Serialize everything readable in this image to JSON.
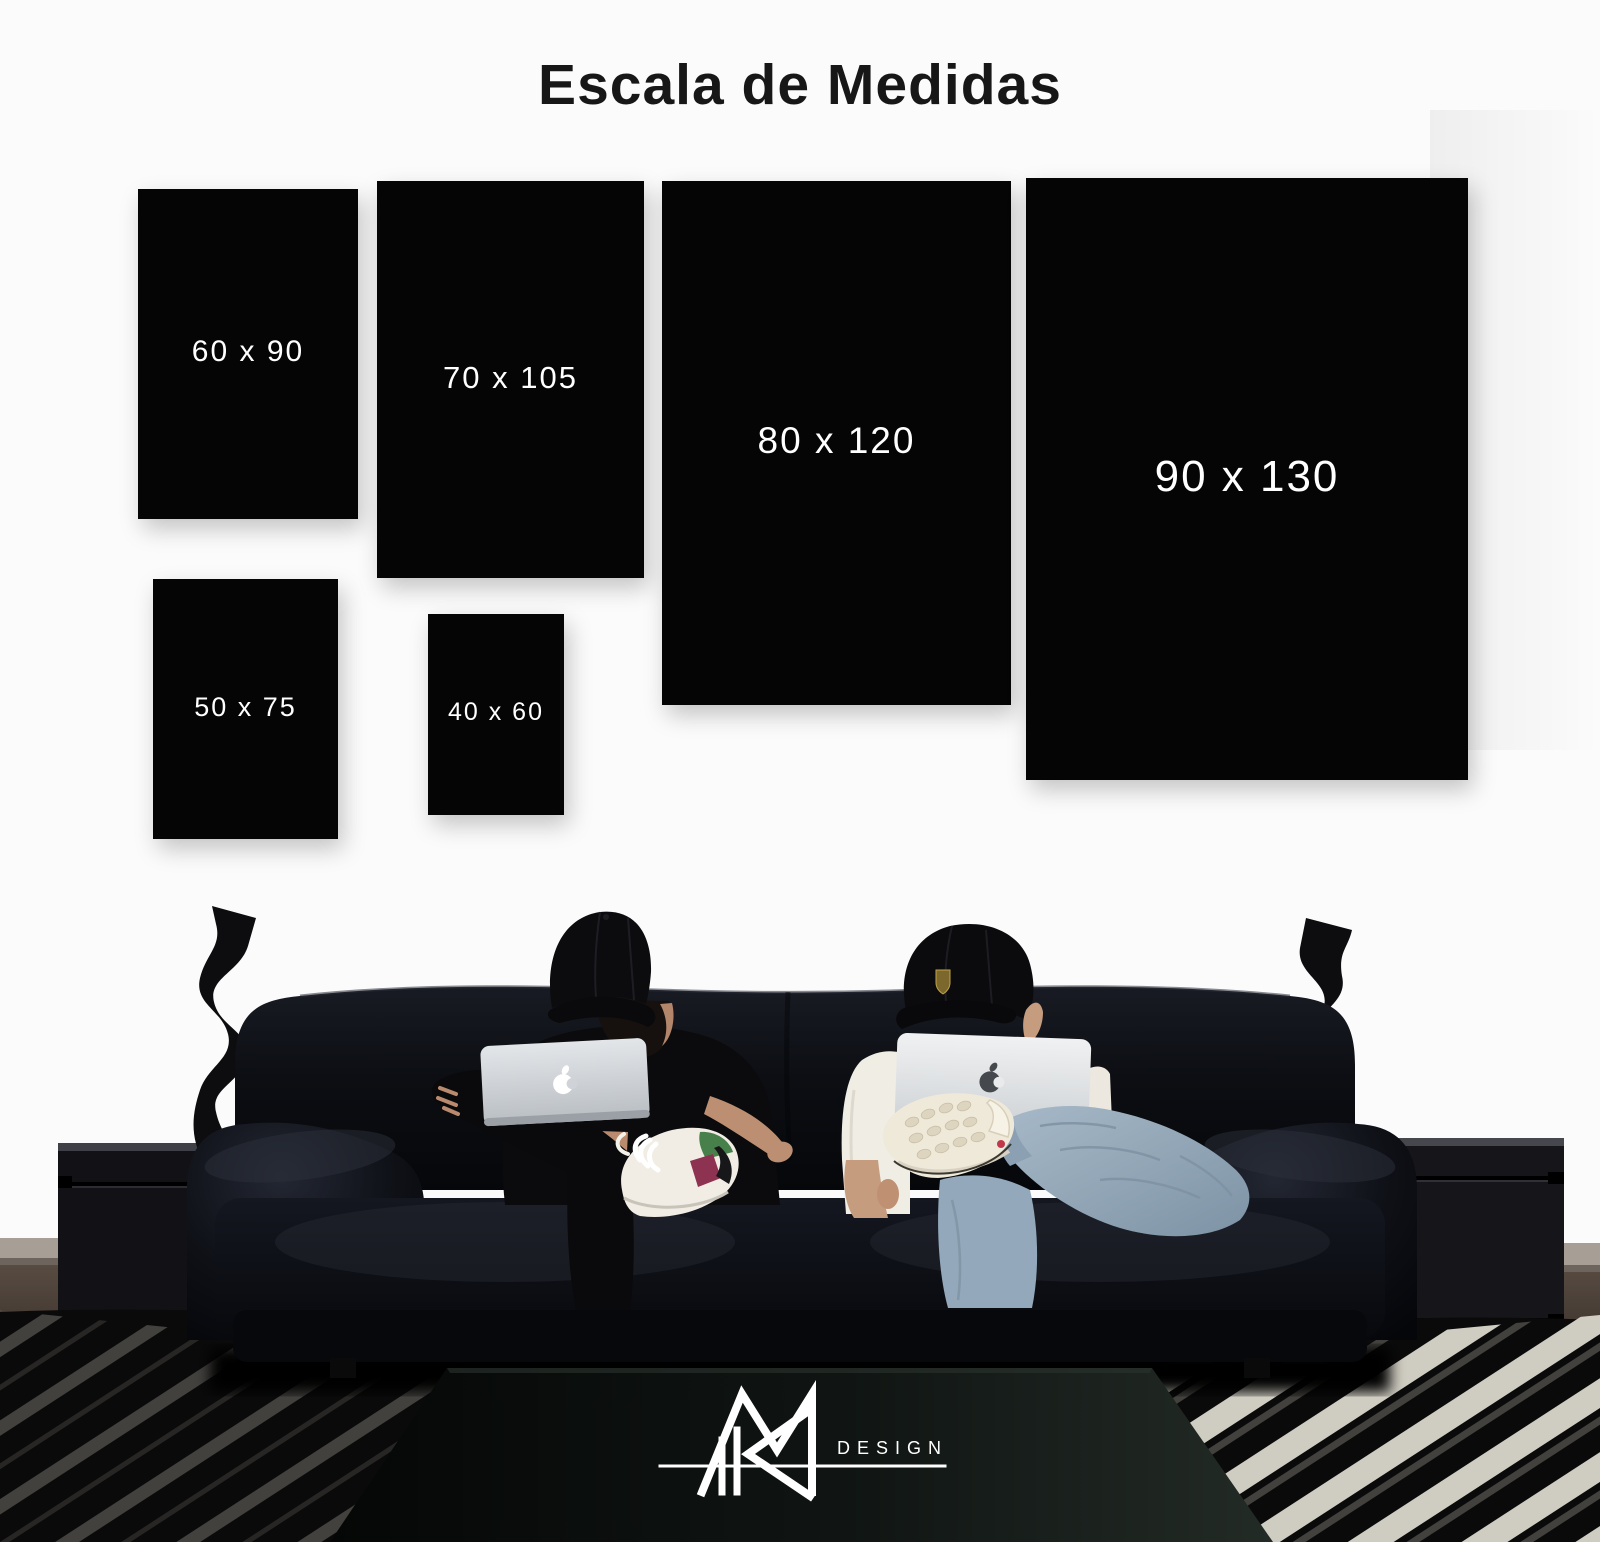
{
  "title": "Escala de Medidas",
  "sizes": [
    {
      "label": "60 x 90"
    },
    {
      "label": "70 x 105"
    },
    {
      "label": "80 x 120"
    },
    {
      "label": "90 x 130"
    },
    {
      "label": "50 x 75"
    },
    {
      "label": "40 x 60"
    }
  ],
  "brand": {
    "wordmark": "DESIGN",
    "monogram": "RM"
  },
  "icons": {
    "apple_logo": "apple-silhouette",
    "cap_badge": "shield-crest",
    "monogram_mark": "geometric-RM-monogram"
  },
  "colors": {
    "background": "#fbfbfb",
    "tile": "#050505",
    "tile_text": "#ffffff",
    "title_text": "#171717",
    "leather": "#0c0e13",
    "denim": "#93a8ba",
    "tee_right": "#f0ede5",
    "skin": "#bd8f72",
    "laptop_silver": "#dfe2e5",
    "logo": "#ffffff"
  }
}
